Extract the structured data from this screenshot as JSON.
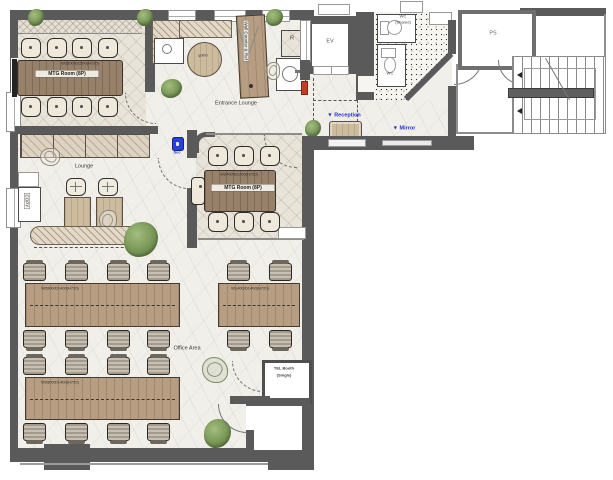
{
  "labels": {
    "mtg_room_1": "MTG Room (8P)",
    "mtg_room_1_dim": "W3200/D1200(H720)",
    "mtg_room_2": "MTG Room (8P)",
    "mtg_room_2_dim": "W2400/D1200(H720)",
    "entrance_lounge": "Entrance Lounge",
    "lounge": "Lounge",
    "office_area": "Office Area",
    "tel_booth_line1": "TEL Booth",
    "tel_booth_line2": "(Single)",
    "reception": "▼ Reception",
    "mirror": "▼ Mirror",
    "security": "Sec",
    "elevator": "EV",
    "pipe_shaft": "PS",
    "restroom": "R",
    "wc_shared_line1": "WC",
    "wc_shared_line2": "(Shared)",
    "wc": "WC",
    "round_table_dim": "φ900",
    "island_counter": "Wall Counter & Ref",
    "copy_machine": "COPY",
    "office_desk_dim": "W2800/D1400(H720)",
    "office_desk2_dim": "W1400/D1400(H720)"
  },
  "colors": {
    "wall": "#5a5a5a",
    "accent_blue": "#2433c8",
    "alert_red": "#c2401f",
    "wood": "#b79e82",
    "plant_green": "#6f8f4f"
  }
}
